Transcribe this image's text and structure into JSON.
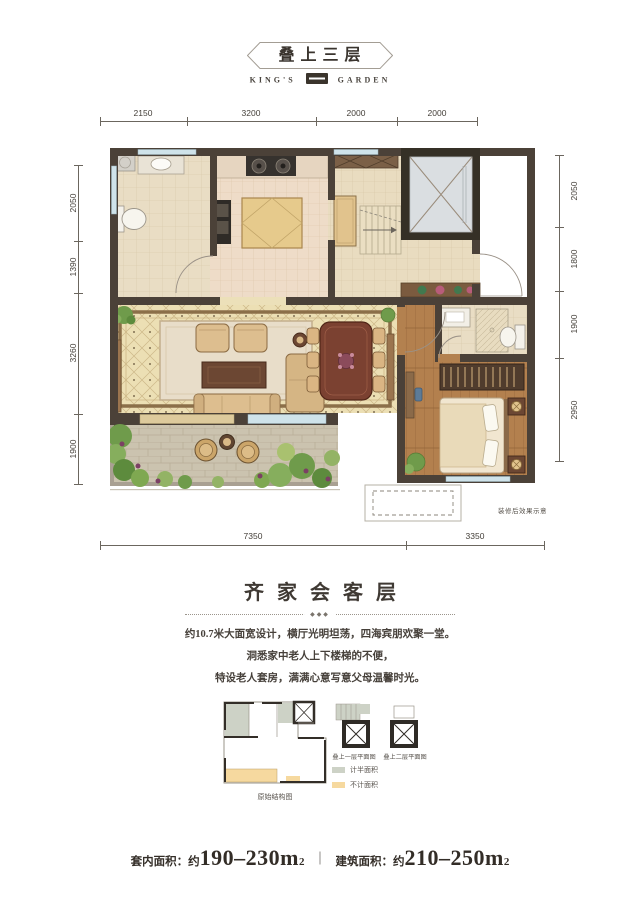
{
  "header": {
    "title": "叠上三层",
    "brand_left": "KING'S",
    "brand_right": "GARDEN"
  },
  "plan": {
    "dims_top": [
      "2150",
      "3200",
      "2000",
      "2000"
    ],
    "dims_left": [
      "2050",
      "1390",
      "3260",
      "1900"
    ],
    "dims_right": [
      "2050",
      "1800",
      "1900",
      "2950"
    ],
    "dims_bottom": [
      "7350",
      "3350"
    ],
    "note": "装修后效果示意"
  },
  "section": {
    "title": "齐家会客层",
    "ornament": "◆◆◆",
    "lines": [
      "约10.7米大面宽设计，横厅光明坦荡，四海宾朋欢聚一堂。",
      "洞悉家中老人上下楼梯的不便，",
      "特设老人套房，满满心意写意父母温馨时光。"
    ]
  },
  "minis": {
    "structure_label": "原始结构图",
    "plan1_label": "叠上一层平面图",
    "plan2_label": "叠上二层平面图",
    "legend": [
      {
        "label": "计半面积",
        "color": "#cdd2c6"
      },
      {
        "label": "不计面积",
        "color": "#f6d99f"
      }
    ]
  },
  "footer": {
    "item1_label": "套内面积：",
    "item1_prefix": "约",
    "item1_value": "190–230m",
    "item1_sup": "2",
    "divider": "｜",
    "item2_label": "建筑面积：",
    "item2_prefix": "约",
    "item2_value": "210–250m",
    "item2_sup": "2"
  }
}
